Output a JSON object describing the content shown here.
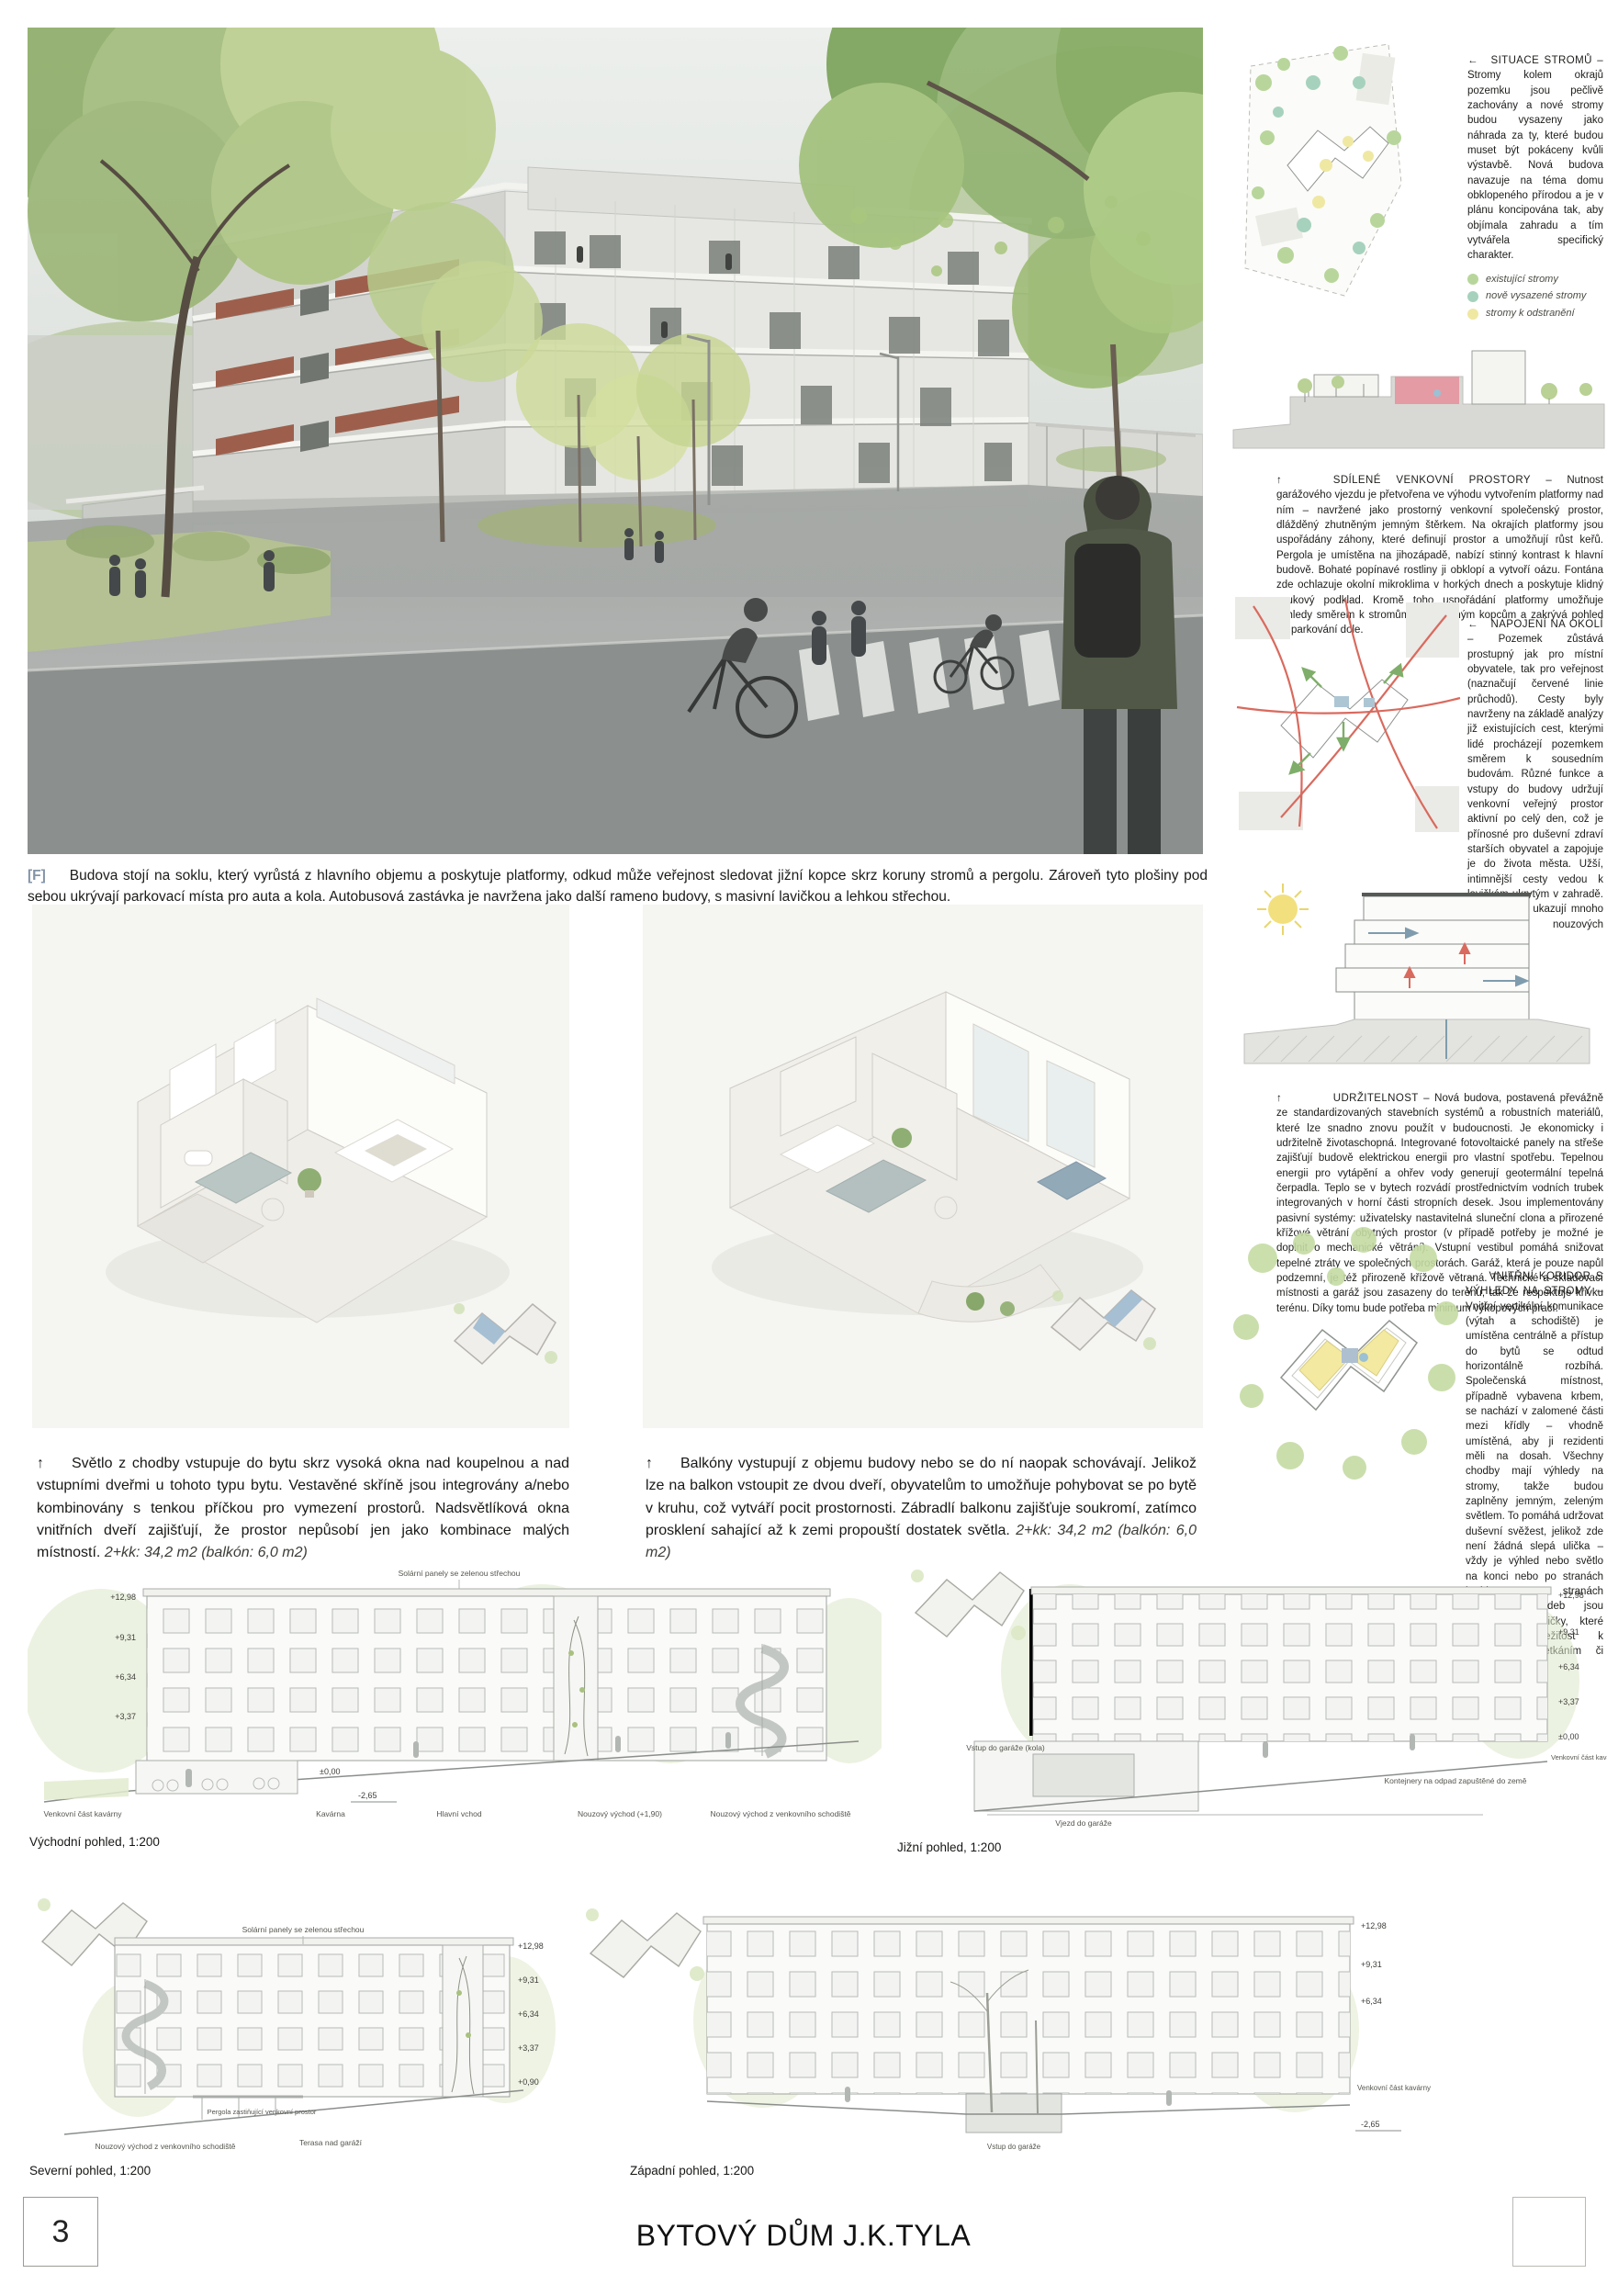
{
  "page": {
    "number": "3",
    "title": "BYTOVÝ DŮM J.K.TYLA"
  },
  "hero": {
    "caption_tag": "[F]",
    "caption": "Budova stojí na soklu, který vyrůstá z hlavního objemu a poskytuje platformy, odkud může veřejnost sledovat jižní kopce skrz koruny stromů a pergolu. Zároveň tyto plošiny pod sebou ukrývají parkovací místa pro auta a kola. Autobusová zastávka je navržena jako další rameno budovy, s masivní lavičkou a lehkou střechou."
  },
  "sidebar": {
    "sections": [
      {
        "arrow": "←",
        "title": "SITUACE STROMŮ –",
        "body": "Stromy kolem okrajů pozemku jsou pečlivě zachovány a nové stromy budou vysazeny jako náhrada za ty, které budou muset být pokáceny kvůli výstavbě. Nová budova navazuje na téma domu obklopeného přírodou a je v plánu koncipována tak, aby objímala zahradu a tím vytvářela specifický charakter.",
        "legend": [
          {
            "label": "existující stromy",
            "color": "#b8d69b"
          },
          {
            "label": "nově vysazené stromy",
            "color": "#a6d2bd"
          },
          {
            "label": "stromy k odstranění",
            "color": "#efe8a2"
          }
        ]
      },
      {
        "arrow": "↑",
        "title": "SDÍLENÉ VENKOVNÍ PROSTORY –",
        "body": "Nutnost garážového vjezdu je přetvořena ve výhodu vytvořením platformy nad ním – navržené jako prostorný venkovní společenský prostor, dlážděný zhutněným jemným štěrkem. Na okrajích platformy jsou uspořádány záhony, které definují prostor a umožňují růst keřů. Pergola je umístěna na jihozápadě, nabízí stinný kontrast k hlavní budově. Bohaté popínavé rostliny ji obklopí a vytvoří oázu. Fontána zde ochlazuje okolní mikroklima v horkých dnech a poskytuje klidný zvukový podklad. Kromě toho uspořádání platformy umožňuje výhledy směrem k stromům a vzdáleným kopcům a zakrývá pohled na parkování dole."
      },
      {
        "arrow": "←",
        "title": "NAPOJENÍ NA OKOLÍ –",
        "body": "Pozemek zůstává prostupný jak pro místní obyvatele, tak pro veřejnost (naznačují červené linie průchodů). Cesty byly navrženy na základě analýzy již existujících cest, kterými lidé procházejí pozemkem směrem k sousedním budovám. Různé funkce a vstupy do budovy udržují venkovní veřejný prostor aktivní po celý den, což je přínosné pro duševní zdraví starších obyvatel a zapojuje je do života města. Užší, intimnější cesty vedou k lavičkám ukrytým v zahradě. Zelené šipky ukazují mnoho možností nouzových východů."
      },
      {
        "arrow": "↑",
        "title": "UDRŽITELNOST –",
        "body": "Nová budova, postavená převážně ze standardizovaných stavebních systémů a robustních materiálů, které lze snadno znovu použít v budoucnosti. Je ekonomicky i udržitelně životaschopná. Integrované fotovoltaické panely na střeše zajišťují budově elektrickou energii pro vlastní spotřebu. Tepelnou energii pro vytápění a ohřev vody generují geotermální tepelná čerpadla. Teplo se v bytech rozvádí prostřednictvím vodních trubek integrovaných v horní části stropních desek. Jsou implementovány pasivní systémy: uživatelsky nastavitelná sluneční clona a přirozené křížové větrání obytných prostor (v případě potřeby je možné je doplnit o mechanické větrání). Vstupní vestibul pomáhá snižovat tepelné ztráty ve společných prostorách. Garáž, která je pouze napůl podzemní, je též přirozeně křížově větraná. Technické a skladovací místnosti a garáž jsou zasazeny do terénu, tak že respektuje křivku terénu. Díky tomu bude potřeba minimum výkopových prací."
      },
      {
        "arrow": "←",
        "title": "VNITŘNÍ KORIDOR S VÝHLEDY NA STROMY –",
        "body": "Vnitřní vertikální komunikace (výtah a schodiště) je umístěna centrálně a přístup do bytů se odtud horizontálně rozbíhá. Společenská místnost, případně vybavena krbem, se nachází v zalomené části mezi křídly – vhodně umístěná, aby ji rezidenti měli na dosah. Všechny chodby mají výhledy na stromy, takže budou zaplněny jemným, zeleným světlem. To pomáhá udržovat duševní svěžest, jelikož zde není žádná slepá ulička – vždy je výhled nebo světlo na konci nebo po stranách koridoru. Na stranách některých chodeb jsou zabudovány lavičky, které poskytují příležitost k neformálním setkáním či rozhovorům."
      }
    ]
  },
  "apartments": [
    {
      "arrow": "↑",
      "body": "Světlo z chodby vstupuje do bytu skrz vysoká okna nad koupelnou a nad vstupními dveřmi u tohoto typu bytu. Vestavěné skříně jsou integrovány a/nebo kombinovány s tenkou příčkou pro vymezení prostorů. Nadsvětlíková okna vnitřních dveří zajišťují, že prostor nepůsobí jen jako kombinace malých místností.",
      "spec": "2+kk: 34,2 m2 (balkón: 6,0 m2)"
    },
    {
      "arrow": "↑",
      "body": "Balkóny vystupují z objemu budovy nebo se do ní naopak schovávají. Jelikož lze na balkon vstoupit ze dvou dveří, obyvatelům to umožňuje pohybovat se po bytě v kruhu, což vytváří pocit prostornosti. Zábradlí balkonu zajišťuje soukromí, zatímco prosklení sahající až k zemi propouští dostatek světla.",
      "spec": "2+kk: 34,2 m2 (balkón: 6,0 m2)"
    }
  ],
  "elevations": {
    "east": {
      "label": "Východní pohled, 1:200",
      "levels": [
        "+12,98",
        "+9,31",
        "+6,34",
        "+3,37",
        "±0,00",
        "-2,65"
      ],
      "annotations": [
        "Solární panely se zelenou střechou",
        "Venkovní část kavárny",
        "Kavárna",
        "Hlavní vchod",
        "Nouzový východ (+1,90)",
        "Nouzový východ z venkovního schodiště"
      ]
    },
    "south": {
      "label": "Jižní pohled, 1:200",
      "levels": [
        "+12,98",
        "+9,31",
        "+6,34",
        "+3,37",
        "±0,00"
      ],
      "annotations": [
        "Vstup do garáže (kola)",
        "Vjezd do garáže",
        "Kontejnery na odpad zapuštěné do země",
        "Venkovní část kavárny"
      ]
    },
    "north": {
      "label": "Severní pohled, 1:200",
      "levels": [
        "+12,98",
        "+9,31",
        "+6,34",
        "+3,37",
        "+0,90"
      ],
      "annotations": [
        "Solární panely se zelenou střechou",
        "Nouzový východ z venkovního schodiště",
        "Pergola zastiňující venkovní prostor",
        "Terasa nad garáží"
      ]
    },
    "west": {
      "label": "Západní pohled, 1:200",
      "levels": [
        "+12,98",
        "+9,31",
        "+6,34",
        "-2,65"
      ],
      "annotations": [
        "Venkovní část kavárny",
        "Vstup do garáže"
      ]
    }
  }
}
